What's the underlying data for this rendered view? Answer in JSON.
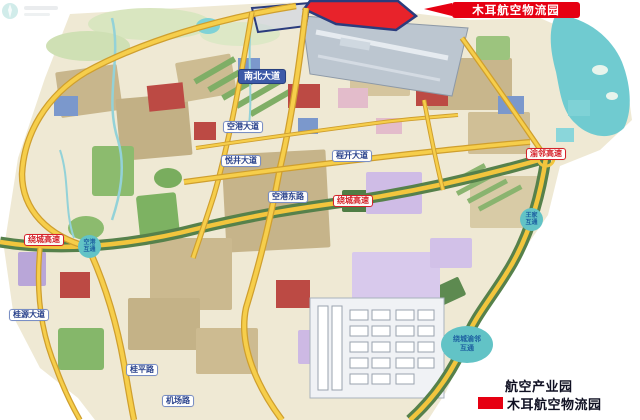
{
  "banner": {
    "label": "木耳航空物流园"
  },
  "legend": {
    "items": [
      {
        "label": "航空产业园",
        "swatch": ""
      },
      {
        "label": "木耳航空物流园",
        "swatch": "#e60012"
      }
    ]
  },
  "roads": {
    "nanbei_avenue": "南北大道",
    "konggang_avenue": "空港大道",
    "yuejing_avenue": "悦井大道",
    "chengkai_avenue": "程开大道",
    "konggang_east_road": "空港东路",
    "ring_expressway_west": "绕城高速",
    "ring_expressway_mid": "绕城高速",
    "yulin_expressway": "渝邻高速",
    "guiyuan_avenue": "桂源大道",
    "guiping_road": "桂平路",
    "jichang_road": "机场路"
  },
  "interchanges": {
    "konggang": {
      "line1": "空港",
      "line2": "互通"
    },
    "wangjia": {
      "line1": "王家",
      "line2": "互通"
    },
    "raocheng_yulin": {
      "line1": "绕城渝邻",
      "line2": "互通"
    }
  },
  "colors": {
    "highlight_red": "#e60012",
    "road_yellow": "#f2c53d",
    "expressway_green": "#56814b",
    "water_teal": "#70cbd0",
    "interchange_teal": "#62c3c6",
    "road_label_blue": "#27408b",
    "district_tan": "#c8b68c"
  }
}
